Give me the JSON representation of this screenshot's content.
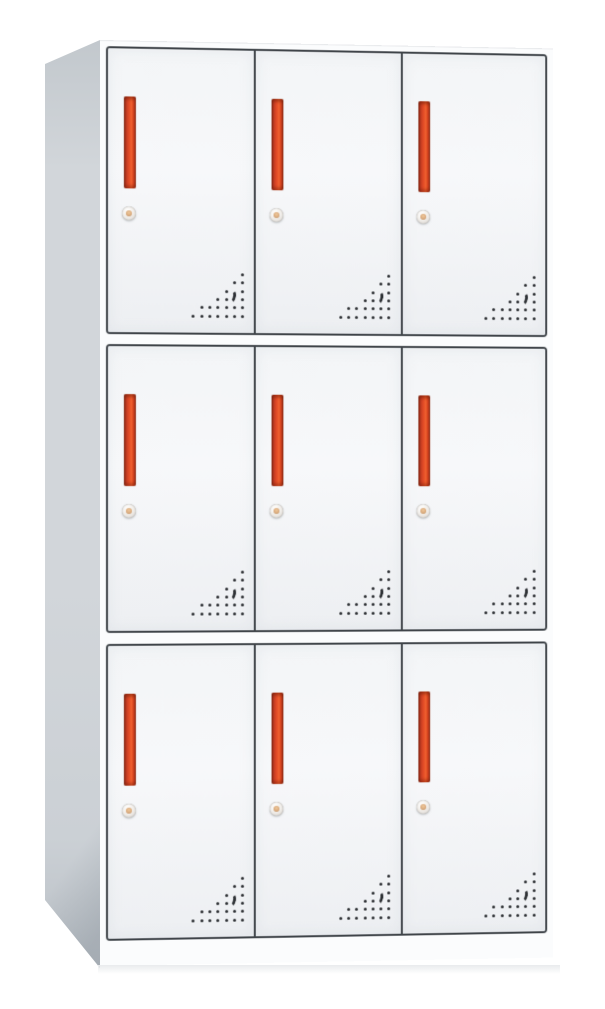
{
  "scene": {
    "description": "White steel locker cabinet, front three-quarter left view, nine doors in a 3x3 grid, each door with a vertical red handle, a round cam lock and a triangular perforated vent pattern in the lower-right corner",
    "background": "plain white"
  },
  "cabinet": {
    "rows": 3,
    "columns": 3,
    "door_count": 9,
    "row_heights_px": [
      288,
      289,
      297
    ],
    "row_gaps_px": [
      10,
      11
    ]
  },
  "door": {
    "handle_icon": "vertical-red-bar-handle",
    "lock_icon": "round-cam-lock",
    "vent_icon": "dot-triangle-vent-with-crescent",
    "vent_pattern": {
      "grid_step_px": 8.3,
      "dot_size_px": 3,
      "rows": [
        [
          6
        ],
        [
          5,
          6
        ],
        [
          4,
          6
        ],
        [
          3,
          4,
          6
        ],
        [
          1,
          2,
          3,
          4,
          5,
          6
        ],
        [
          0,
          1,
          2,
          3,
          4,
          5,
          6
        ]
      ],
      "crescent": {
        "left_px": 35,
        "top_px": 16
      }
    }
  },
  "colors": {
    "bg": "#ffffff",
    "front-frame": "#fbfcfd",
    "door-face-top": "#f3f5f7",
    "door-face-mid": "#f7f8fa",
    "door-face-bottom": "#edeff2",
    "door-outline": "#3f4449",
    "side-top": "#c2c8cd",
    "side-mid": "#d2d6da",
    "side-low": "#cbd0d5",
    "side-bottom": "#b9bfc5",
    "handle-edge": "#8e2f1d",
    "handle-mid": "#e44d27",
    "handle-bright": "#ee5f2e",
    "handle-deep": "#9c3520",
    "lock-ring": "#d9d4cf",
    "lock-core": "#d8a97c",
    "vent-dot": "#2c2f33",
    "shadow": "#e9ebed"
  }
}
